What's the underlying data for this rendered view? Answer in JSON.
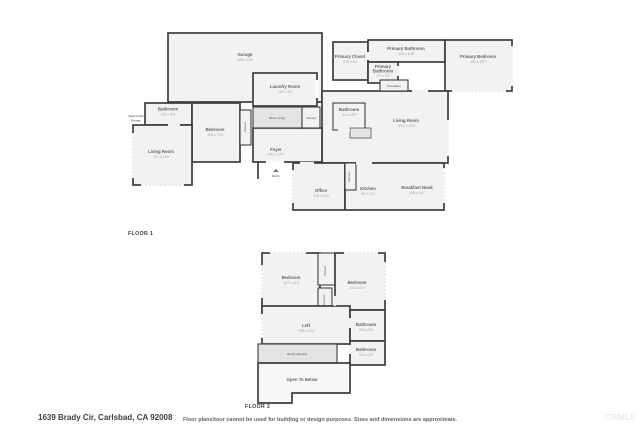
{
  "colors": {
    "wall": "#3e3e3e",
    "room_fill": "#f2f2f2",
    "stairs_fill": "#e4e4e4",
    "label_text": "#5f6368",
    "dims_text": "#9aa0a6"
  },
  "footer": {
    "address": "1639 Brady Cir, Carlsbad, CA 92008",
    "disclaimer": "Floor plans/tour cannot be used for building or design purposes. Sizes and dimensions are approximate.",
    "watermark": "CRMLS"
  },
  "floor1": {
    "label": "FLOOR 1",
    "rooms": {
      "garage": {
        "name": "Garage",
        "dims": "28'8 x 19'2"
      },
      "laundry": {
        "name": "Laundry Room",
        "dims": "16'2 x 6'0"
      },
      "primary_closet": {
        "name": "Primary Closet",
        "dims": "9'10 x 6'4"
      },
      "primary_bathroom": {
        "name": "Primary Bathroom",
        "dims": "14'8 x 10'8"
      },
      "primary_bathroom_2": {
        "name_line1": "Primary",
        "name_line2": "Bathroom",
        "dims": "5'7 x 4'8"
      },
      "primary_bedroom": {
        "name": "Primary Bedroom",
        "dims": "15'5 x 18'7"
      },
      "fireplace": {
        "name": "Fireplace"
      },
      "bathroom_left": {
        "name": "Bathroom",
        "dims": "10'9 x 4'11"
      },
      "space_not_shown": {
        "name_line1": "Space Not",
        "name_line2": "Shown"
      },
      "bedroom": {
        "name": "Bedroom",
        "dims": "10'9 x 11'8"
      },
      "closet_bedroom": {
        "name": "Closet"
      },
      "living_room_left": {
        "name": "Living Room",
        "dims": "13'7 x 14'8"
      },
      "stairs": {
        "name": "Stairs (Up)"
      },
      "closet_hall": {
        "name": "Closet"
      },
      "foyer": {
        "name": "Foyer",
        "dims": "6'11 x 10'7"
      },
      "entry": {
        "name": "Entry"
      },
      "bathroom_center": {
        "name": "Bathroom",
        "dims": "4'11 x 8'9"
      },
      "living_room": {
        "name": "Living Room",
        "dims": "18'11 x 19'8"
      },
      "closet_office": {
        "name": "Closet"
      },
      "office": {
        "name": "Office",
        "dims": "13'9 x 13'2"
      },
      "kitchen": {
        "name": "Kitchen",
        "dims": "9'0 x 10'7"
      },
      "breakfast_nook": {
        "name": "Breakfast Nook",
        "dims": "14'8 x 14'7"
      }
    }
  },
  "floor2": {
    "label": "FLOOR 2",
    "rooms": {
      "bedroom_left": {
        "name": "Bedroom",
        "dims": "14'7 x 11'8"
      },
      "closet_upper": {
        "name": "Closet"
      },
      "closet_lower": {
        "name": "Closet"
      },
      "bedroom_right": {
        "name": "Bedroom",
        "dims": "13'3 x 14'7"
      },
      "loft": {
        "name": "Loft",
        "dims": "19'8 x 13'4"
      },
      "bathroom_upper": {
        "name": "Bathroom",
        "dims": "5'11 x 8'9"
      },
      "bathroom_lower": {
        "name": "Bathroom",
        "dims": "5'11 x 4'9"
      },
      "stairs": {
        "name": "Stairs (Down)"
      },
      "open_to_below": {
        "name": "Open To Below"
      }
    }
  }
}
